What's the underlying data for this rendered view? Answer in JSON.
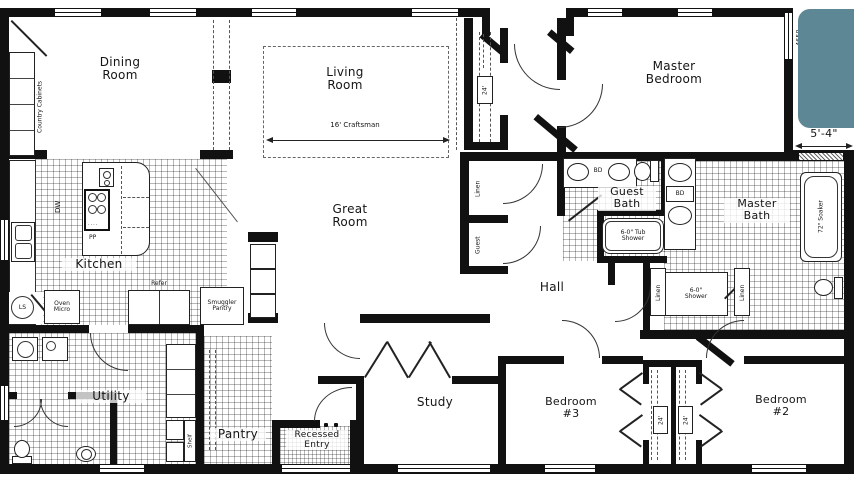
{
  "title": "Manufactured home floor plan",
  "colors": {
    "wall": "#111111",
    "teal_block": "#5d8794",
    "paper": "#ffffff",
    "text": "#151515"
  },
  "rooms": {
    "dining": {
      "label": "Dining\nRoom"
    },
    "living": {
      "label": "Living\nRoom"
    },
    "master_bedroom": {
      "label": "Master\nBedroom"
    },
    "kitchen": {
      "label": "Kitchen"
    },
    "great_room": {
      "label": "Great\nRoom"
    },
    "hall": {
      "label": "Hall"
    },
    "guest_bath": {
      "label": "Guest\nBath"
    },
    "master_bath": {
      "label": "Master\nBath"
    },
    "utility": {
      "label": "Utility"
    },
    "pantry": {
      "label": "Pantry"
    },
    "recessed_entry": {
      "label": "Recessed\nEntry"
    },
    "study": {
      "label": "Study"
    },
    "bedroom3": {
      "label": "Bedroom\n#3"
    },
    "bedroom2": {
      "label": "Bedroom\n#2"
    }
  },
  "fixtures": {
    "country_cabinets": "Country Cabinets",
    "dishwasher": "DW",
    "lazy_susan": "LS",
    "oven_micro": "Oven\nMicro",
    "refrigerator": "Refer",
    "smuggler_pantry": "Smuggler\nPantry",
    "island_pp": "PP",
    "entry_closet_shelf": "24'",
    "hall_linen": "Linen",
    "hall_guest": "Guest",
    "guest_bath_bd": "BD",
    "guest_tub": "6-0\" Tub\nShower",
    "master_bath_bd": "BD",
    "soaker_tub": "72\" Soaker",
    "master_shower": "6-0\"\nShower",
    "master_linen_a": "Linen",
    "master_linen_b": "Linen",
    "utility_shelf": "Shelf",
    "closet3_shelf": "24'",
    "closet2_shelf": "24'"
  },
  "dimensions": {
    "living_width": "16' Craftsman",
    "master_offset": "5'-4\"",
    "window_model": "4658"
  }
}
